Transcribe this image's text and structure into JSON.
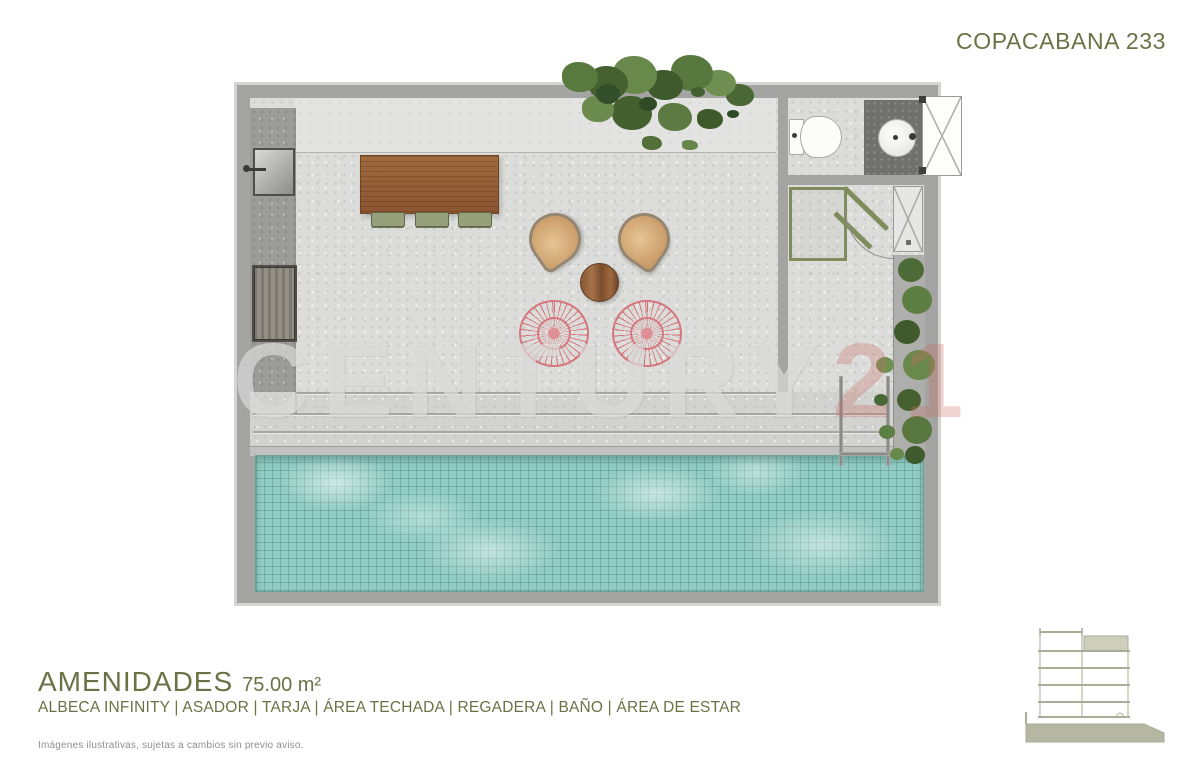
{
  "header": {
    "title": "COPACABANA 233"
  },
  "footer": {
    "title": "AMENIDADES",
    "area": "75.00 m²",
    "amenities_line": "ALBECA INFINITY | ASADOR | TARJA | ÁREA TECHADA | REGADERA | BAÑO | ÁREA DE ESTAR",
    "disclaimer": "Imágenes ilustrativas, sujetas a cambios sin previo aviso."
  },
  "watermark": {
    "text_main": "CENTURY",
    "text_suffix": "21"
  },
  "plan": {
    "fixtures": [
      "infinity-pool",
      "pool-ladder",
      "grill-asador",
      "sink-tarja",
      "bar-table",
      "bar-stools",
      "lounge-chairs",
      "acapulco-chairs",
      "coffee-table",
      "toilet",
      "bathroom-sink",
      "shower",
      "entry-door",
      "planters",
      "deck-steps"
    ]
  },
  "colors": {
    "accent_olive": "#6B7245",
    "wall_gray": "#A4A4A2",
    "floor_gray": "#DCDCDA",
    "pool_turquoise": "#90CCC3",
    "wood_brown": "#8A5530",
    "chair_pink": "#D4787E",
    "plant_green": "#4C6B36",
    "counter_gray": "#70706E"
  }
}
